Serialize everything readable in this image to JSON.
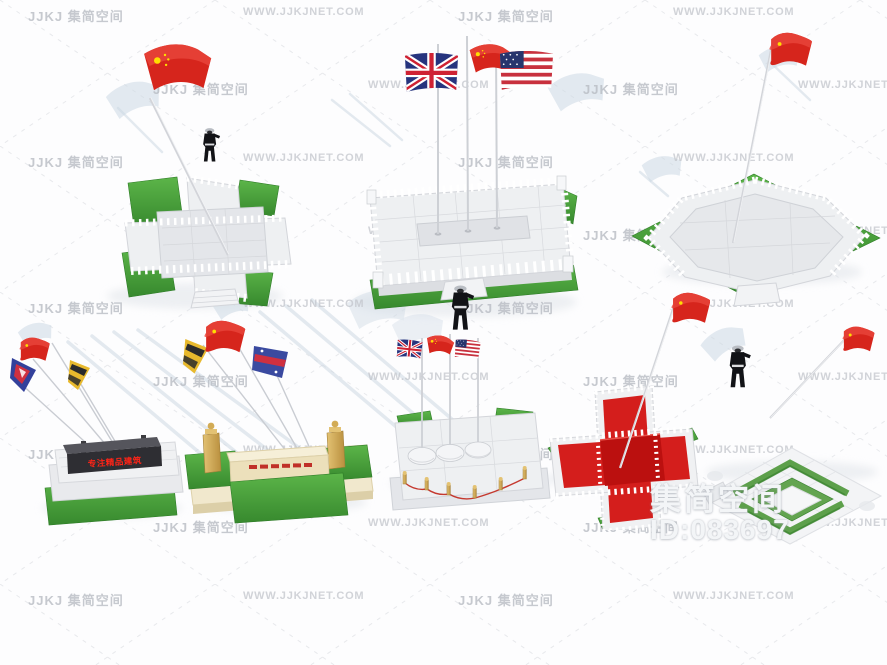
{
  "image": {
    "kind": "3d-model-preview-collage",
    "subject": "flagpole platform / flag podium 3D models, two rows of four",
    "width": 887,
    "height": 665
  },
  "watermark": {
    "logo_text": "JJKJ 集简空间",
    "url_text": "WWW.JJKJNET.COM",
    "rows": [
      {
        "y": 6,
        "tiles": [
          {
            "x": 28,
            "t": "logo"
          },
          {
            "x": 243,
            "t": "url"
          },
          {
            "x": 458,
            "t": "logo"
          },
          {
            "x": 673,
            "t": "url"
          }
        ]
      },
      {
        "y": 79,
        "tiles": [
          {
            "x": 153,
            "t": "logo"
          },
          {
            "x": 368,
            "t": "url"
          },
          {
            "x": 583,
            "t": "logo"
          },
          {
            "x": 798,
            "t": "url"
          }
        ]
      },
      {
        "y": 152,
        "tiles": [
          {
            "x": 28,
            "t": "logo"
          },
          {
            "x": 243,
            "t": "url"
          },
          {
            "x": 458,
            "t": "logo"
          },
          {
            "x": 673,
            "t": "url"
          }
        ]
      },
      {
        "y": 225,
        "tiles": [
          {
            "x": 153,
            "t": "logo"
          },
          {
            "x": 368,
            "t": "url"
          },
          {
            "x": 583,
            "t": "logo"
          },
          {
            "x": 798,
            "t": "url"
          }
        ]
      },
      {
        "y": 298,
        "tiles": [
          {
            "x": 28,
            "t": "logo"
          },
          {
            "x": 243,
            "t": "url"
          },
          {
            "x": 458,
            "t": "logo"
          },
          {
            "x": 673,
            "t": "url"
          }
        ]
      },
      {
        "y": 371,
        "tiles": [
          {
            "x": 153,
            "t": "logo"
          },
          {
            "x": 368,
            "t": "url"
          },
          {
            "x": 583,
            "t": "logo"
          },
          {
            "x": 798,
            "t": "url"
          }
        ]
      },
      {
        "y": 444,
        "tiles": [
          {
            "x": 28,
            "t": "logo"
          },
          {
            "x": 243,
            "t": "url"
          },
          {
            "x": 458,
            "t": "logo"
          },
          {
            "x": 673,
            "t": "url"
          }
        ]
      },
      {
        "y": 517,
        "tiles": [
          {
            "x": 153,
            "t": "logo"
          },
          {
            "x": 368,
            "t": "url"
          },
          {
            "x": 583,
            "t": "logo"
          },
          {
            "x": 798,
            "t": "url"
          }
        ]
      },
      {
        "y": 590,
        "tiles": [
          {
            "x": 28,
            "t": "logo"
          },
          {
            "x": 243,
            "t": "url"
          },
          {
            "x": 458,
            "t": "logo"
          },
          {
            "x": 673,
            "t": "url"
          }
        ]
      }
    ]
  },
  "badge": {
    "brand": "集简空间",
    "id": "ID:083697"
  },
  "led_sign": {
    "text": "专注精品建筑"
  },
  "models": [
    {
      "name": "cross-plaza-platform",
      "flags": [
        "china"
      ],
      "figure": true
    },
    {
      "name": "rectangular-three-flag-platform",
      "flags": [
        "united-kingdom",
        "china",
        "united-states"
      ],
      "figure": true
    },
    {
      "name": "octagonal-balustrade-platform",
      "flags": [
        "china"
      ],
      "figure": false
    },
    {
      "name": "led-sign-podium",
      "flags": [
        "red-flag",
        "navy-pennant",
        "yellow-pennant"
      ],
      "figure": false
    },
    {
      "name": "twin-pillar-podium",
      "flags": [
        "yellow-pennant",
        "red-flag",
        "blue-banner"
      ],
      "figure": false
    },
    {
      "name": "dome-base-three-flag-platform",
      "flags": [
        "united-kingdom",
        "china",
        "united-states"
      ],
      "figure": true
    },
    {
      "name": "red-carpet-cross-platform",
      "flags": [
        "china"
      ],
      "figure": false
    },
    {
      "name": "hedge-garden-platform",
      "flags": [
        "red-flag"
      ],
      "figure": true
    }
  ],
  "colors": {
    "flag_red": "#d6251c",
    "flag_red_dark": "#b01910",
    "grass_green": "#4aa83c",
    "grass_dark": "#2f7d28",
    "stone_light": "#eef0f2",
    "stone_shade": "#d4d6db",
    "carpet_red": "#d41e1c",
    "cream": "#f1e8cd",
    "gold": "#d2ab55",
    "sign_body": "#2e2e33",
    "led_red": "#ff2417",
    "uk_blue": "#26347e",
    "us_blue": "#27356d",
    "stripe_red": "#c8313e",
    "watermark_gray": "#b8bcc3",
    "ghost_blue": "#cdd9e4",
    "badge_white": "#f3f5f7"
  }
}
